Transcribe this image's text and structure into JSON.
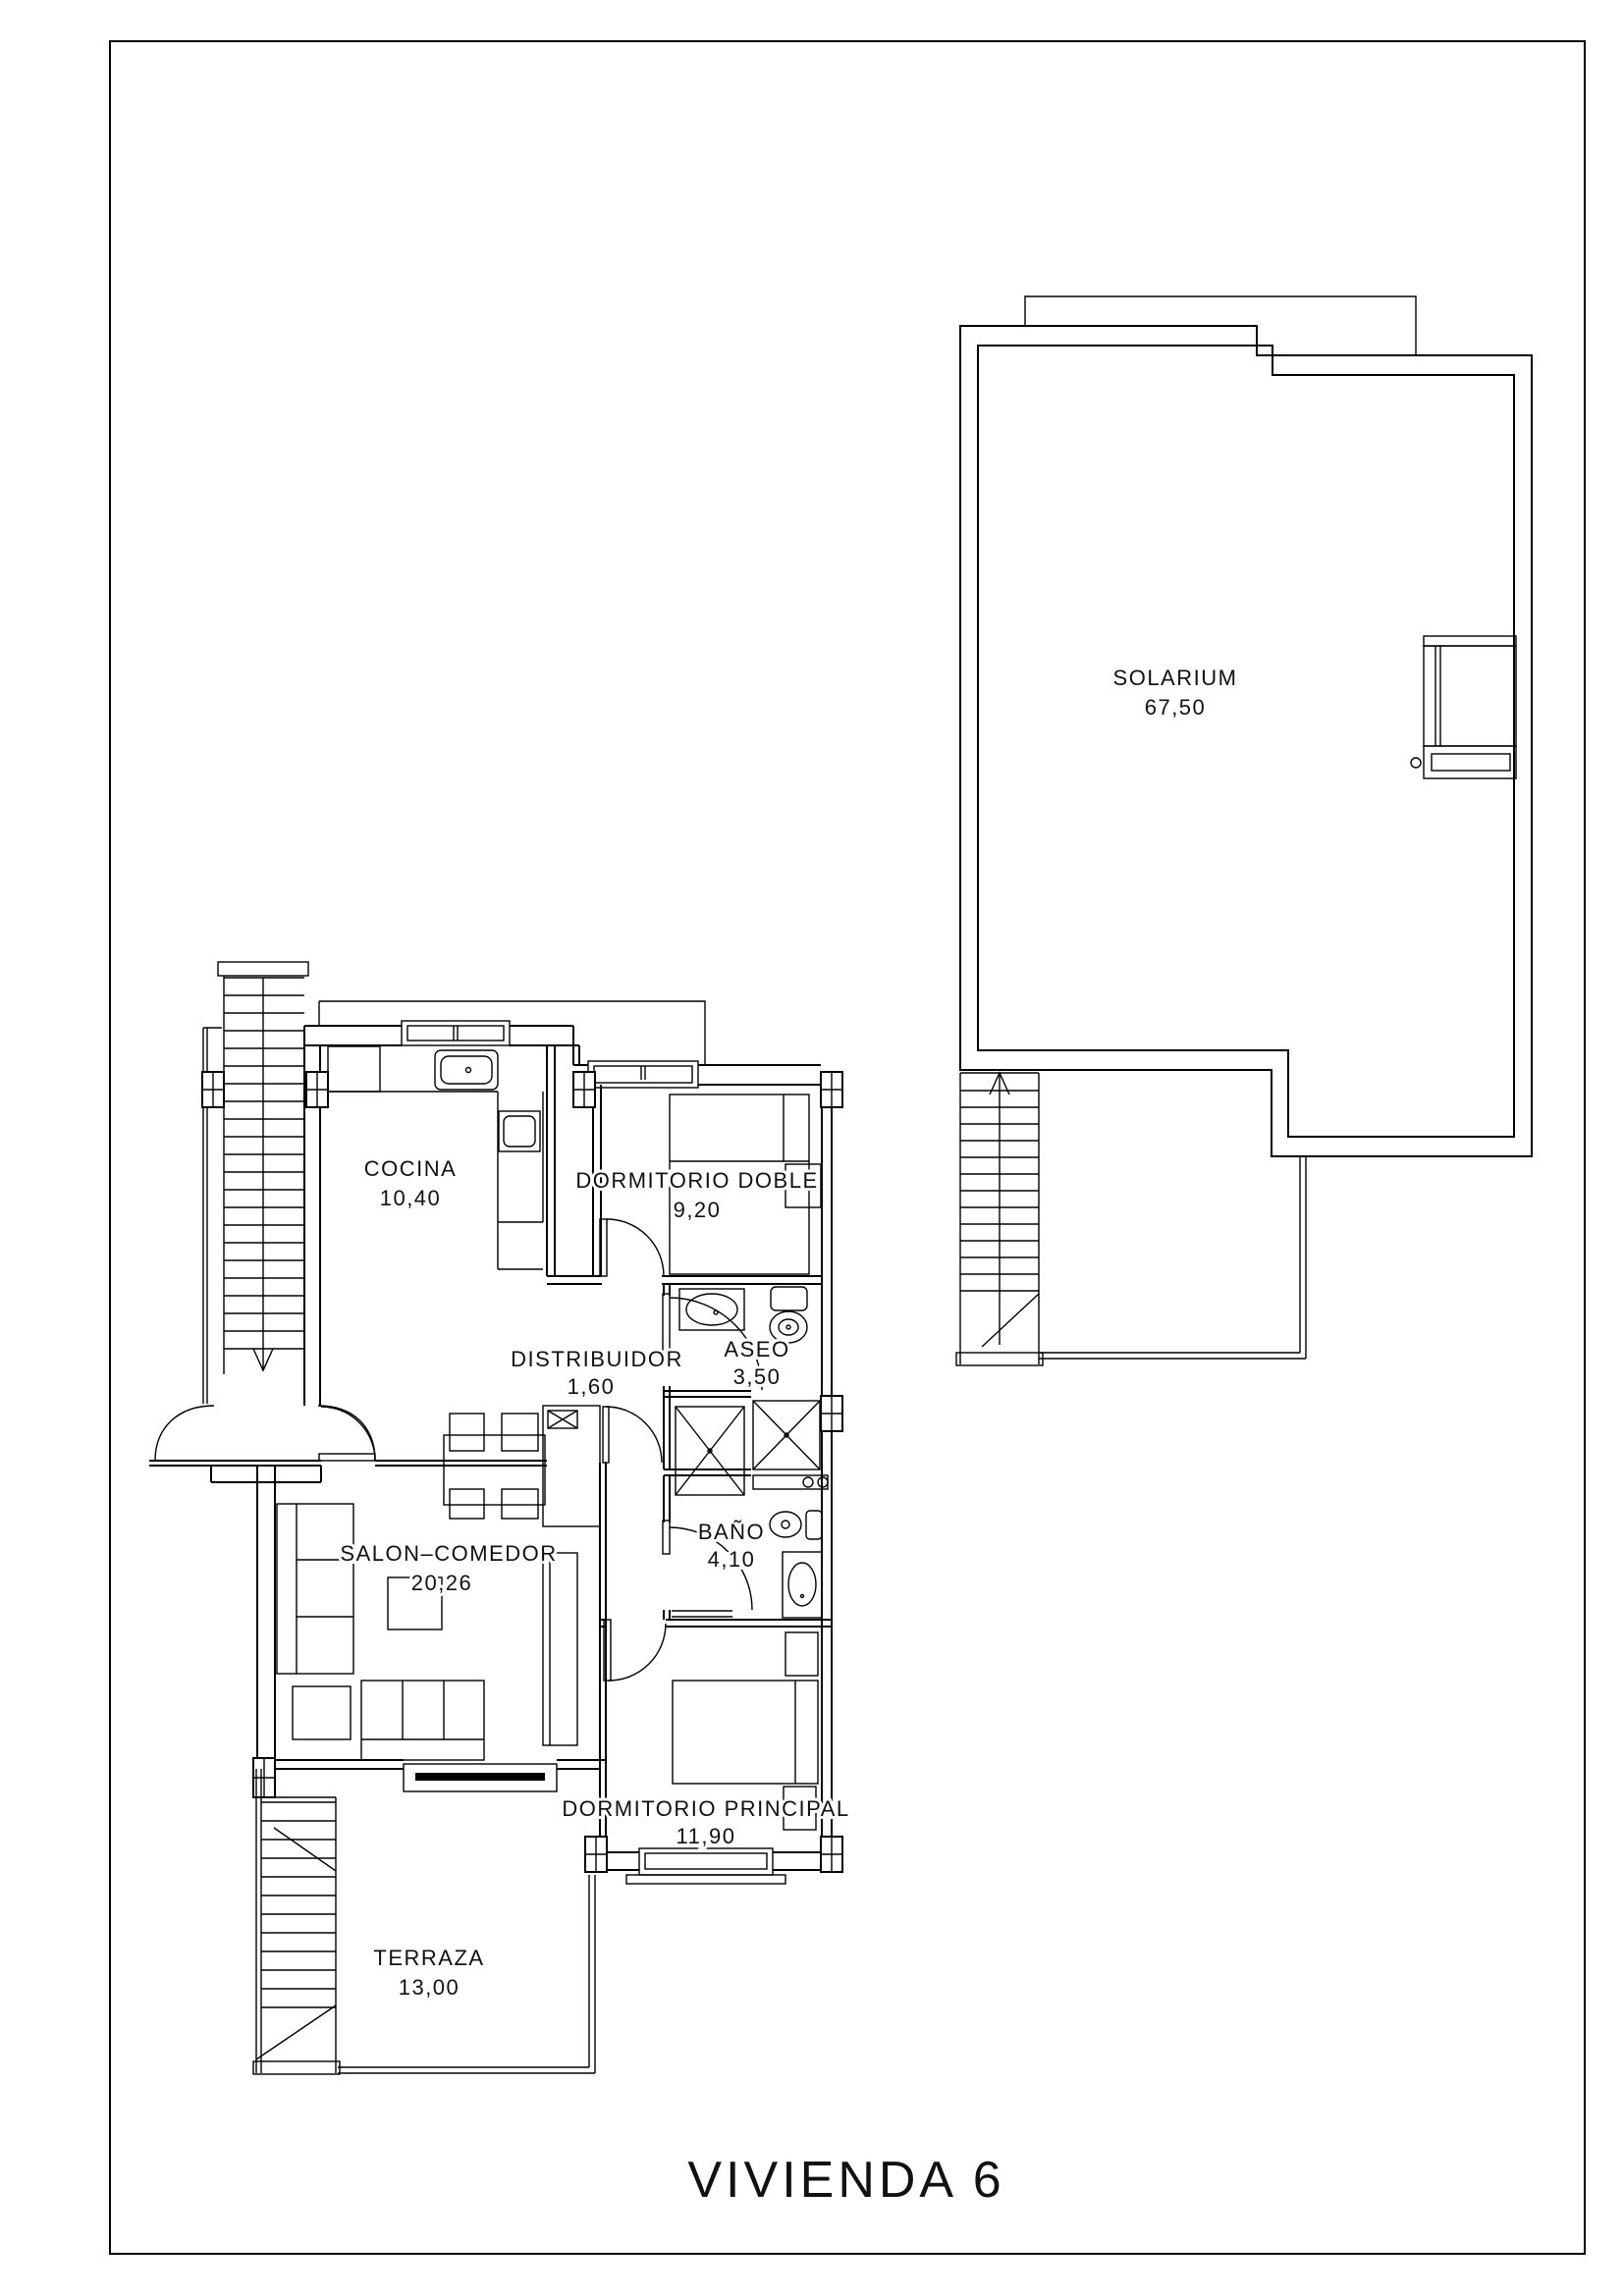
{
  "title": "VIVIENDA  6",
  "colors": {
    "paper": "#ffffff",
    "line": "#000000",
    "text": "#111111"
  },
  "rooms": [
    {
      "id": "solarium",
      "name": "SOLARIUM",
      "area": "67,50"
    },
    {
      "id": "cocina",
      "name": "COCINA",
      "area": "10,40"
    },
    {
      "id": "dormitorio-doble",
      "name": "DORMITORIO  DOBLE",
      "area": "9,20"
    },
    {
      "id": "distribuidor",
      "name": "DISTRIBUIDOR",
      "area": "1,60"
    },
    {
      "id": "aseo",
      "name": "ASEO",
      "area": "3,50"
    },
    {
      "id": "salon-comedor",
      "name": "SALON–COMEDOR",
      "area": "20,26"
    },
    {
      "id": "bano",
      "name": "BAÑO",
      "area": "4,10"
    },
    {
      "id": "dormitorio-principal",
      "name": "DORMITORIO  PRINCIPAL",
      "area": "11,90"
    },
    {
      "id": "terraza",
      "name": "TERRAZA",
      "area": "13,00"
    }
  ]
}
